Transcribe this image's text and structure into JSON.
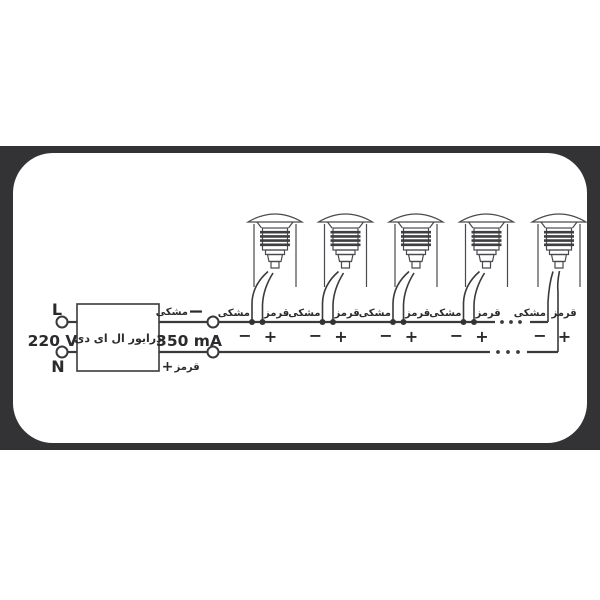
{
  "colors": {
    "page_background": "#ffffff",
    "frame": "#333336",
    "panel": "#ffffff",
    "line_art": "#3a3a3e",
    "text": "#2b2b2e"
  },
  "diagram": {
    "mains": {
      "line_label": "L",
      "neutral_label": "N",
      "voltage": "220 V"
    },
    "driver": {
      "label": "درایور ال ای دی",
      "current": "350 mA"
    },
    "wire_labels": {
      "black": "مشکی",
      "red": "قرمز"
    },
    "signs": {
      "minus": "−",
      "plus": "+"
    },
    "lights_shown": 5,
    "continuation_marks": "···"
  }
}
